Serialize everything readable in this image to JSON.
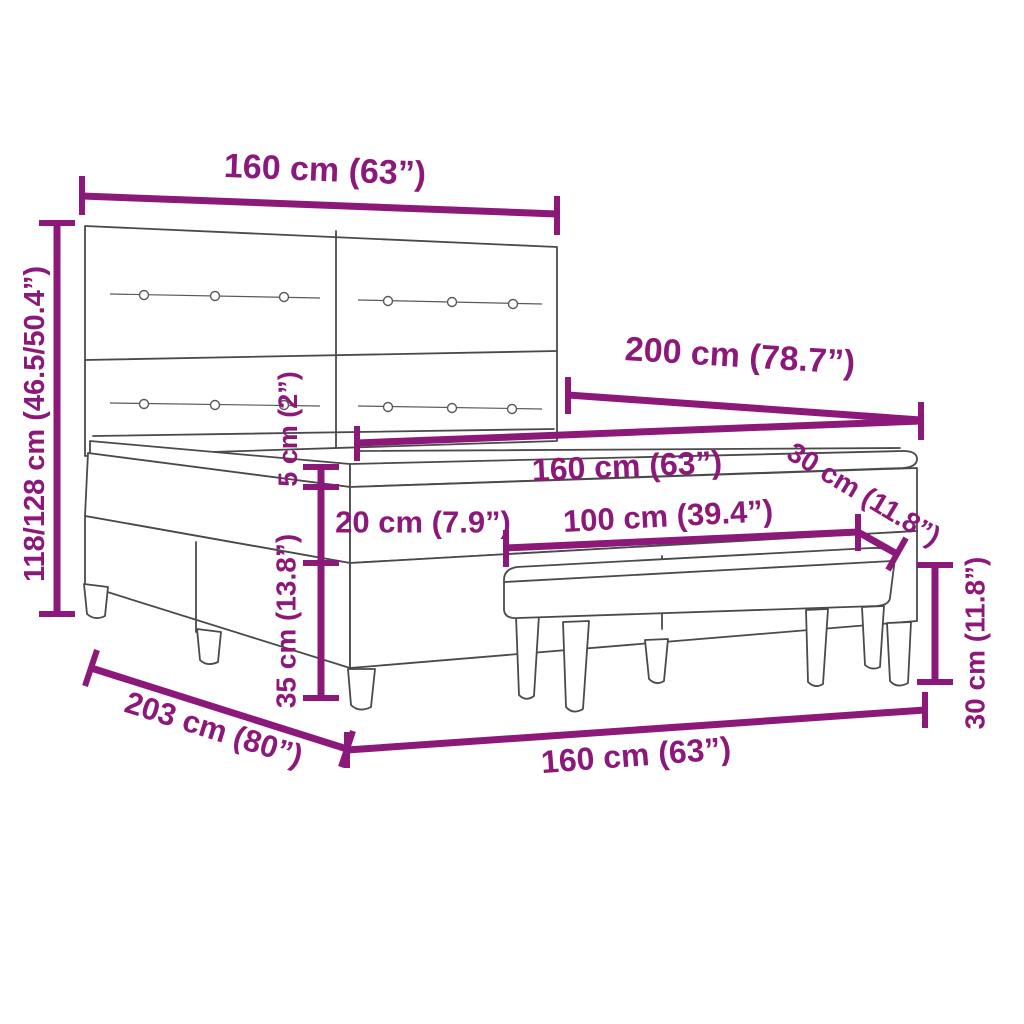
{
  "diagram": {
    "kind": "product dimension drawing",
    "background": "#ffffff",
    "accent_color": "#8C1879",
    "artwork_line_color": "#4a4a4a"
  },
  "dimensions": {
    "headboard_width": "160 cm (63”)",
    "total_height": "118/128 cm (46.5/50.4”)",
    "bed_length": "200 cm (78.7”)",
    "mattress_width": "160 cm (63”)",
    "topper_thickness": "5 cm (2”)",
    "mattress_thickness": "20 cm (7.9”)",
    "base_height": "35 cm (13.8”)",
    "bench_length": "100 cm (39.4”)",
    "bench_depth": "30 cm (11.8”)",
    "bench_height": "30 cm (11.8”)",
    "frame_floor_length": "203 cm (80”)",
    "bed_floor_width": "160 cm (63”)"
  }
}
